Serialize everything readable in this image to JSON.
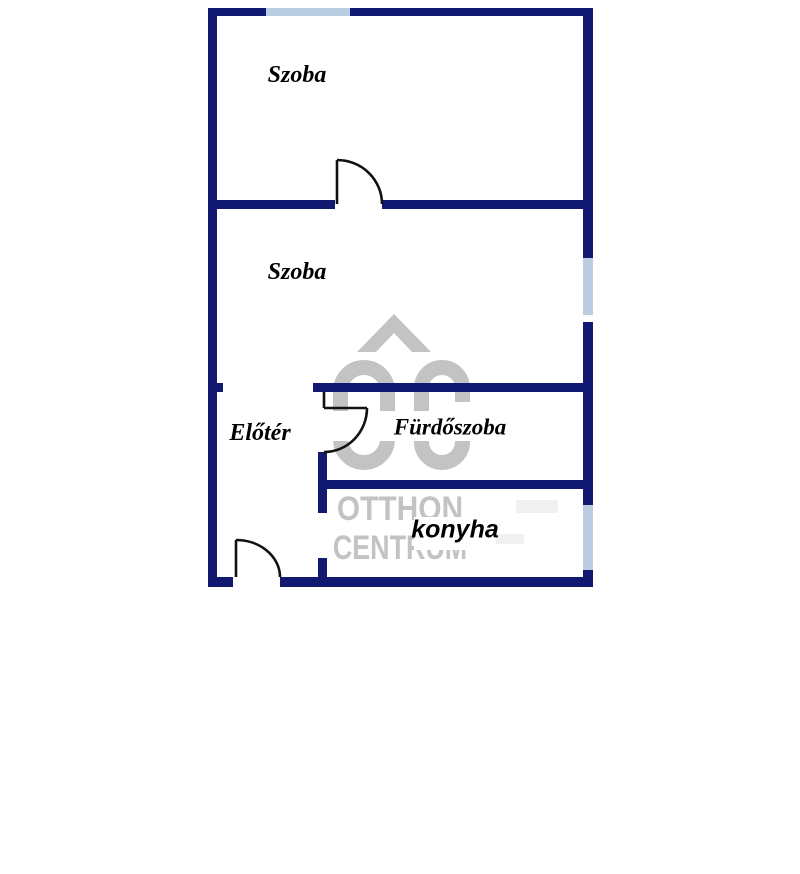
{
  "floorplan": {
    "rooms": [
      {
        "id": "szoba-1",
        "label": "Szoba"
      },
      {
        "id": "szoba-2",
        "label": "Szoba"
      },
      {
        "id": "eloter",
        "label": "Előtér"
      },
      {
        "id": "furdoszoba",
        "label": "Fürdőszoba"
      },
      {
        "id": "konyha",
        "label": "konyha"
      }
    ],
    "watermark": {
      "logo": "otthon-centrum-roof-oc-logo",
      "line1": "OTTHON",
      "line2": "CENTRUM",
      "color": "#c3c3c3"
    },
    "colors": {
      "wall": "#111a70",
      "window": "#b9cfe1",
      "door_line": "#111111",
      "label_text": "#000000",
      "background": "#ffffff"
    }
  }
}
